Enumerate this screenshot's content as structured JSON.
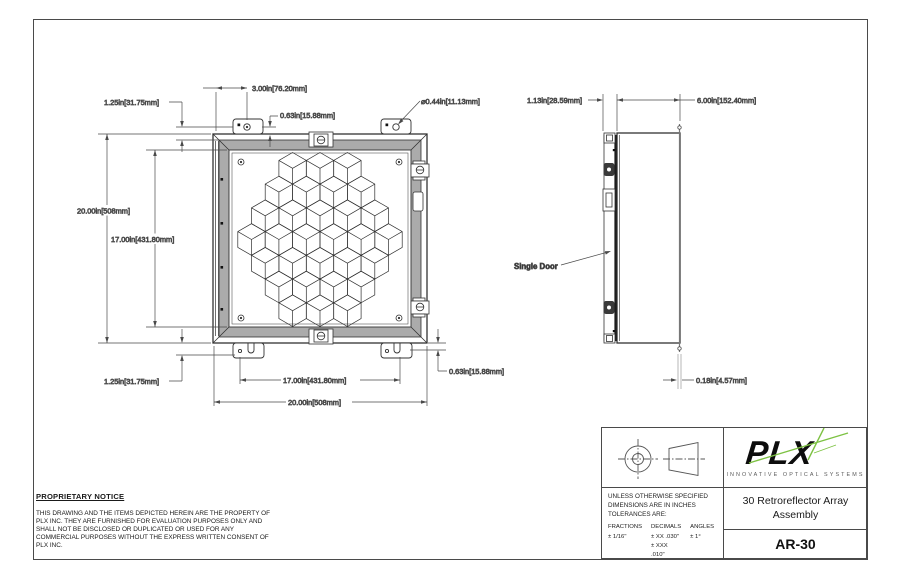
{
  "drawing": {
    "front": {
      "dim_width_tab": "3.00in[76.20mm]",
      "dim_tab_offset_top": "0.63in[15.88mm]",
      "dim_hole_dia": "⌀0.44in[11.13mm]",
      "dim_tab_edge_top": "1.25in[31.75mm]",
      "dim_height_outer": "20.00in[508mm]",
      "dim_height_inner": "17.00in[431.80mm]",
      "dim_tab_edge_bottom": "1.25in[31.75mm]",
      "dim_width_inner": "17.00in[431.80mm]",
      "dim_width_outer": "20.00in[508mm]",
      "dim_tab_offset_bottom": "0.63in[15.88mm]",
      "array_rows": [
        3,
        4,
        5,
        6,
        5,
        4,
        3
      ]
    },
    "side": {
      "dim_door_depth": "1.13in[28.59mm]",
      "dim_body_depth": "6.00in[152.40mm]",
      "dim_flange_thk": "0.18in[4.57mm]",
      "door_label": "Single Door"
    }
  },
  "notice": {
    "title": "PROPRIETARY NOTICE",
    "lines": [
      "THIS DRAWING AND THE ITEMS DEPICTED HEREIN ARE THE PROPERTY OF",
      "PLX INC. THEY ARE FURNISHED FOR EVALUATION PURPOSES ONLY AND",
      "SHALL NOT BE DISCLOSED OR DUPLICATED OR USED FOR ANY",
      "COMMERCIAL PURPOSES WITHOUT THE EXPRESS WRITTEN CONSENT OF",
      "PLX INC."
    ]
  },
  "title_block": {
    "logo_text": "PLX",
    "logo_tagline": "INNOVATIVE OPTICAL SYSTEMS",
    "logo_green": "#7dc243",
    "title_line1": "30 Retroreflector Array",
    "title_line2": "Assembly",
    "part_number": "AR-30",
    "tol_header_lines": [
      "UNLESS OTHERWISE SPECIFIED",
      "DIMENSIONS ARE IN INCHES",
      "TOLERANCES ARE:"
    ],
    "col_fractions": "FRACTIONS",
    "col_decimals": "DECIMALS",
    "col_angles": "ANGLES",
    "val_fractions": "± 1/16\"",
    "val_decimals_1": "± XX  .030\"",
    "val_decimals_2": "± XXX .010\"",
    "val_angles": "± 1°"
  }
}
